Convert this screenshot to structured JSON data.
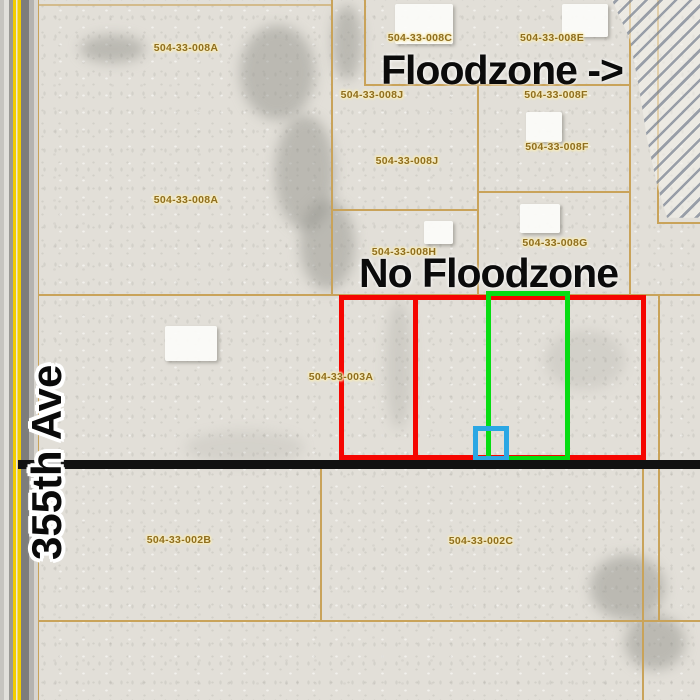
{
  "title": "Parcel map with floodzone annotation",
  "road": {
    "label": "355th Ave"
  },
  "annotations": {
    "floodzone_arrow": "Floodzone ->",
    "no_floodzone": "No Floodzone"
  },
  "parcel_labels": [
    "504-33-008A",
    "504-33-008C",
    "504-33-008E",
    "504-33-008J",
    "504-33-008F",
    "504-33-008F",
    "504-33-008J",
    "504-33-008A",
    "504-33-008H",
    "504-33-008G",
    "504-33-003A",
    "504-33-002B",
    "504-33-002C"
  ],
  "colors": {
    "parcel_line": "#c9a35a",
    "parcel_label": "#8f6e1e",
    "label_halo": "#f8ecbb",
    "highlight_red": "#f50500",
    "highlight_green": "#06dd12",
    "highlight_blue": "#2ba7e4",
    "section_line": "#111111",
    "road_stripe_yellow": "#f2cd00",
    "floodzone_hatch": "#8b939f"
  }
}
